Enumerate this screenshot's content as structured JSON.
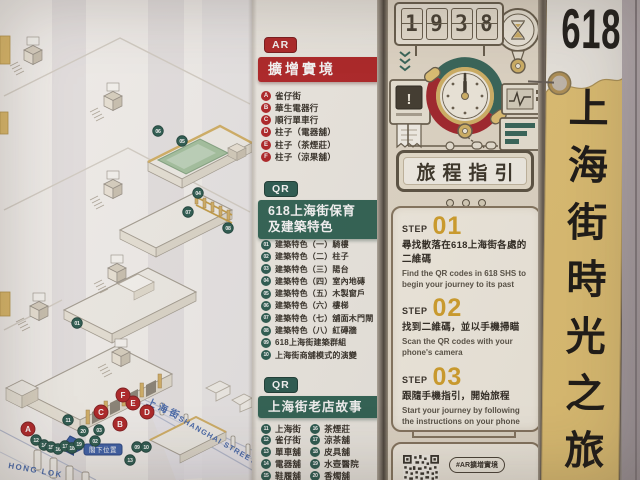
{
  "poster": {
    "tag": {
      "number": "618",
      "title": "上海街時光之旅"
    },
    "map": {
      "street_zh": "上海街",
      "street_en": "SHANGHAI STREET",
      "cross_street": "HONG LOK",
      "you_are_here": "閣下位置",
      "ar_pins": [
        {
          "label": "A",
          "x": 28,
          "y": 429
        },
        {
          "label": "B",
          "x": 120,
          "y": 424
        },
        {
          "label": "C",
          "x": 101,
          "y": 412
        },
        {
          "label": "D",
          "x": 147,
          "y": 412
        },
        {
          "label": "E",
          "x": 133,
          "y": 403
        },
        {
          "label": "F",
          "x": 123,
          "y": 395
        }
      ],
      "qr_pins": [
        {
          "label": "06",
          "x": 158,
          "y": 131
        },
        {
          "label": "05",
          "x": 182,
          "y": 141
        },
        {
          "label": "04",
          "x": 198,
          "y": 193
        },
        {
          "label": "07",
          "x": 188,
          "y": 212
        },
        {
          "label": "08",
          "x": 228,
          "y": 228
        },
        {
          "label": "01",
          "x": 77,
          "y": 323
        },
        {
          "label": "11",
          "x": 68,
          "y": 420
        },
        {
          "label": "20",
          "x": 83,
          "y": 431
        },
        {
          "label": "03",
          "x": 99,
          "y": 430
        },
        {
          "label": "02",
          "x": 95,
          "y": 441
        },
        {
          "label": "12",
          "x": 36,
          "y": 440
        },
        {
          "label": "14",
          "x": 44,
          "y": 445
        },
        {
          "label": "15",
          "x": 51,
          "y": 447
        },
        {
          "label": "16",
          "x": 58,
          "y": 449
        },
        {
          "label": "17",
          "x": 65,
          "y": 446
        },
        {
          "label": "18",
          "x": 72,
          "y": 448
        },
        {
          "label": "19",
          "x": 79,
          "y": 444
        },
        {
          "label": "09",
          "x": 137,
          "y": 447
        },
        {
          "label": "10",
          "x": 146,
          "y": 447
        },
        {
          "label": "13",
          "x": 130,
          "y": 460
        }
      ]
    },
    "legend": {
      "ar": {
        "badge": "AR",
        "heading": "擴增實境",
        "items": [
          {
            "key": "A",
            "label": "雀仔街"
          },
          {
            "key": "B",
            "label": "華生電器行"
          },
          {
            "key": "C",
            "label": "順行單車行"
          },
          {
            "key": "D",
            "label": "柱子（電器舖）"
          },
          {
            "key": "E",
            "label": "柱子（茶煙莊）"
          },
          {
            "key": "F",
            "label": "柱子（涼果舖）"
          }
        ]
      },
      "qr_features": {
        "badge": "QR",
        "heading_line1": "618上海街保育",
        "heading_line2": "及建築特色",
        "items": [
          {
            "key": "01",
            "label": "建築特色（一）騎樓"
          },
          {
            "key": "02",
            "label": "建築特色（二）柱子"
          },
          {
            "key": "03",
            "label": "建築特色（三）陽台"
          },
          {
            "key": "04",
            "label": "建築特色（四）室內地磚"
          },
          {
            "key": "05",
            "label": "建築特色（五）木製窗戶"
          },
          {
            "key": "06",
            "label": "建築特色（六）樓梯"
          },
          {
            "key": "07",
            "label": "建築特色（七）舖面木門閘"
          },
          {
            "key": "08",
            "label": "建築特色（八）紅磚牆"
          },
          {
            "key": "09",
            "label": "618上海街建築群組"
          },
          {
            "key": "10",
            "label": "上海街商舖模式的演變"
          }
        ]
      },
      "qr_shops": {
        "badge": "QR",
        "heading": "上海街老店故事",
        "left": [
          {
            "key": "11",
            "label": "上海街"
          },
          {
            "key": "12",
            "label": "雀仔街"
          },
          {
            "key": "13",
            "label": "單車舖"
          },
          {
            "key": "14",
            "label": "電器舖"
          },
          {
            "key": "15",
            "label": "鞋履舖"
          }
        ],
        "right": [
          {
            "key": "16",
            "label": "茶煙莊"
          },
          {
            "key": "17",
            "label": "涼茶舖"
          },
          {
            "key": "18",
            "label": "皮具舖"
          },
          {
            "key": "19",
            "label": "水壺醫院"
          },
          {
            "key": "20",
            "label": "香燭舖"
          }
        ]
      }
    },
    "guide": {
      "title": "旅程指引",
      "step_label": "STEP",
      "flip_cells": [
        {
          "top": "1",
          "bottom": "1"
        },
        {
          "top": "9",
          "bottom": "9"
        },
        {
          "top": "2",
          "bottom": "3"
        },
        {
          "top": "8",
          "bottom": "0"
        }
      ],
      "steps": [
        {
          "num": "01",
          "zh": "尋找散落在618上海街各處的二維碼",
          "en": "Find the QR codes in 618 SHS to begin your journey to its past"
        },
        {
          "num": "02",
          "zh": "找到二維碼，並以手機掃瞄",
          "en": "Scan the QR codes with your phone's camera"
        },
        {
          "num": "03",
          "zh": "跟隨手機指引，開始旅程",
          "en": "Start your journey by following the instructions on your phone"
        }
      ],
      "qr_hashtag": "#AR擴增實境"
    },
    "colors": {
      "ar_red": "#b5282a",
      "qr_green": "#336758",
      "qr_pin_teal": "#2e5f54",
      "step_gold": "#d9a62e",
      "tag_gold": "#e8c878",
      "street_blue": "#4a6db1",
      "panel_cream": "#f9f4e8"
    }
  }
}
